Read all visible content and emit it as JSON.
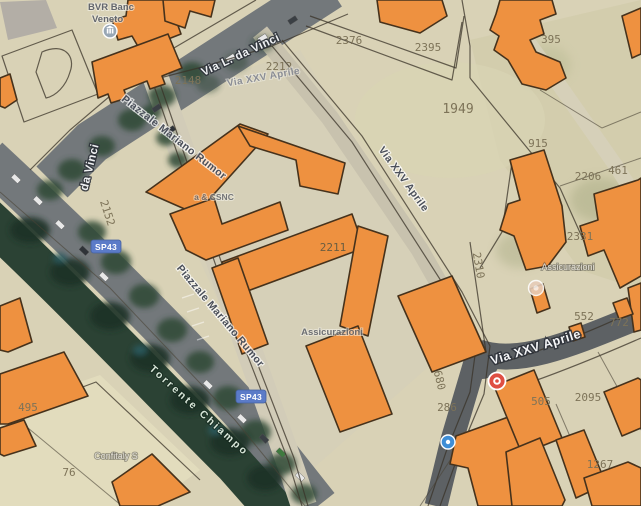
{
  "map_type": "satellite-cadastral-hybrid",
  "streets": {
    "via_l_da_vinci": "Via L. da Vinci",
    "da_vinci": "da Vinci",
    "piazzale_mariano_rumor": "Piazzale Mariano Rumor",
    "via_xxv_aprile": "Via XXV Aprile",
    "torrente_chiampo": "Torrente Chiampo"
  },
  "shields": {
    "sp43": "SP43"
  },
  "pois": {
    "bank_line1": "BVR Banc",
    "bank_line2": "Veneto",
    "business_csnc": "a & CSNC",
    "assicurazioni_central": "Assicurazioni",
    "assicurazioni_right": "Assicurazioni",
    "confitaly": "Confitaly S"
  },
  "parcels": {
    "p76": "76",
    "p286": "286",
    "p395": "395",
    "p461": "461",
    "p495": "495",
    "p505": "505",
    "p552": "552",
    "p680": "680",
    "p772": "772",
    "p915": "915",
    "p1267": "1267",
    "p1949": "1949",
    "p2095": "2095",
    "p2148": "2148",
    "p2152": "2152",
    "p2206": "2206",
    "p2211": "2211",
    "p2212": "2212",
    "p2310": "2310",
    "p2331": "2331",
    "p2376": "2376",
    "p2395": "2395"
  },
  "colors": {
    "building_fill": "#ee9140",
    "building_stroke": "#46321c",
    "road_dark": "#73787b",
    "road_light": "#d2ccb8",
    "water_green": "#2b4234",
    "shield_blue": "#5b7bc8",
    "parcel_line": "#3a3328",
    "parcel_number": "#7d7358",
    "base_beige": "#d9d2b6"
  }
}
